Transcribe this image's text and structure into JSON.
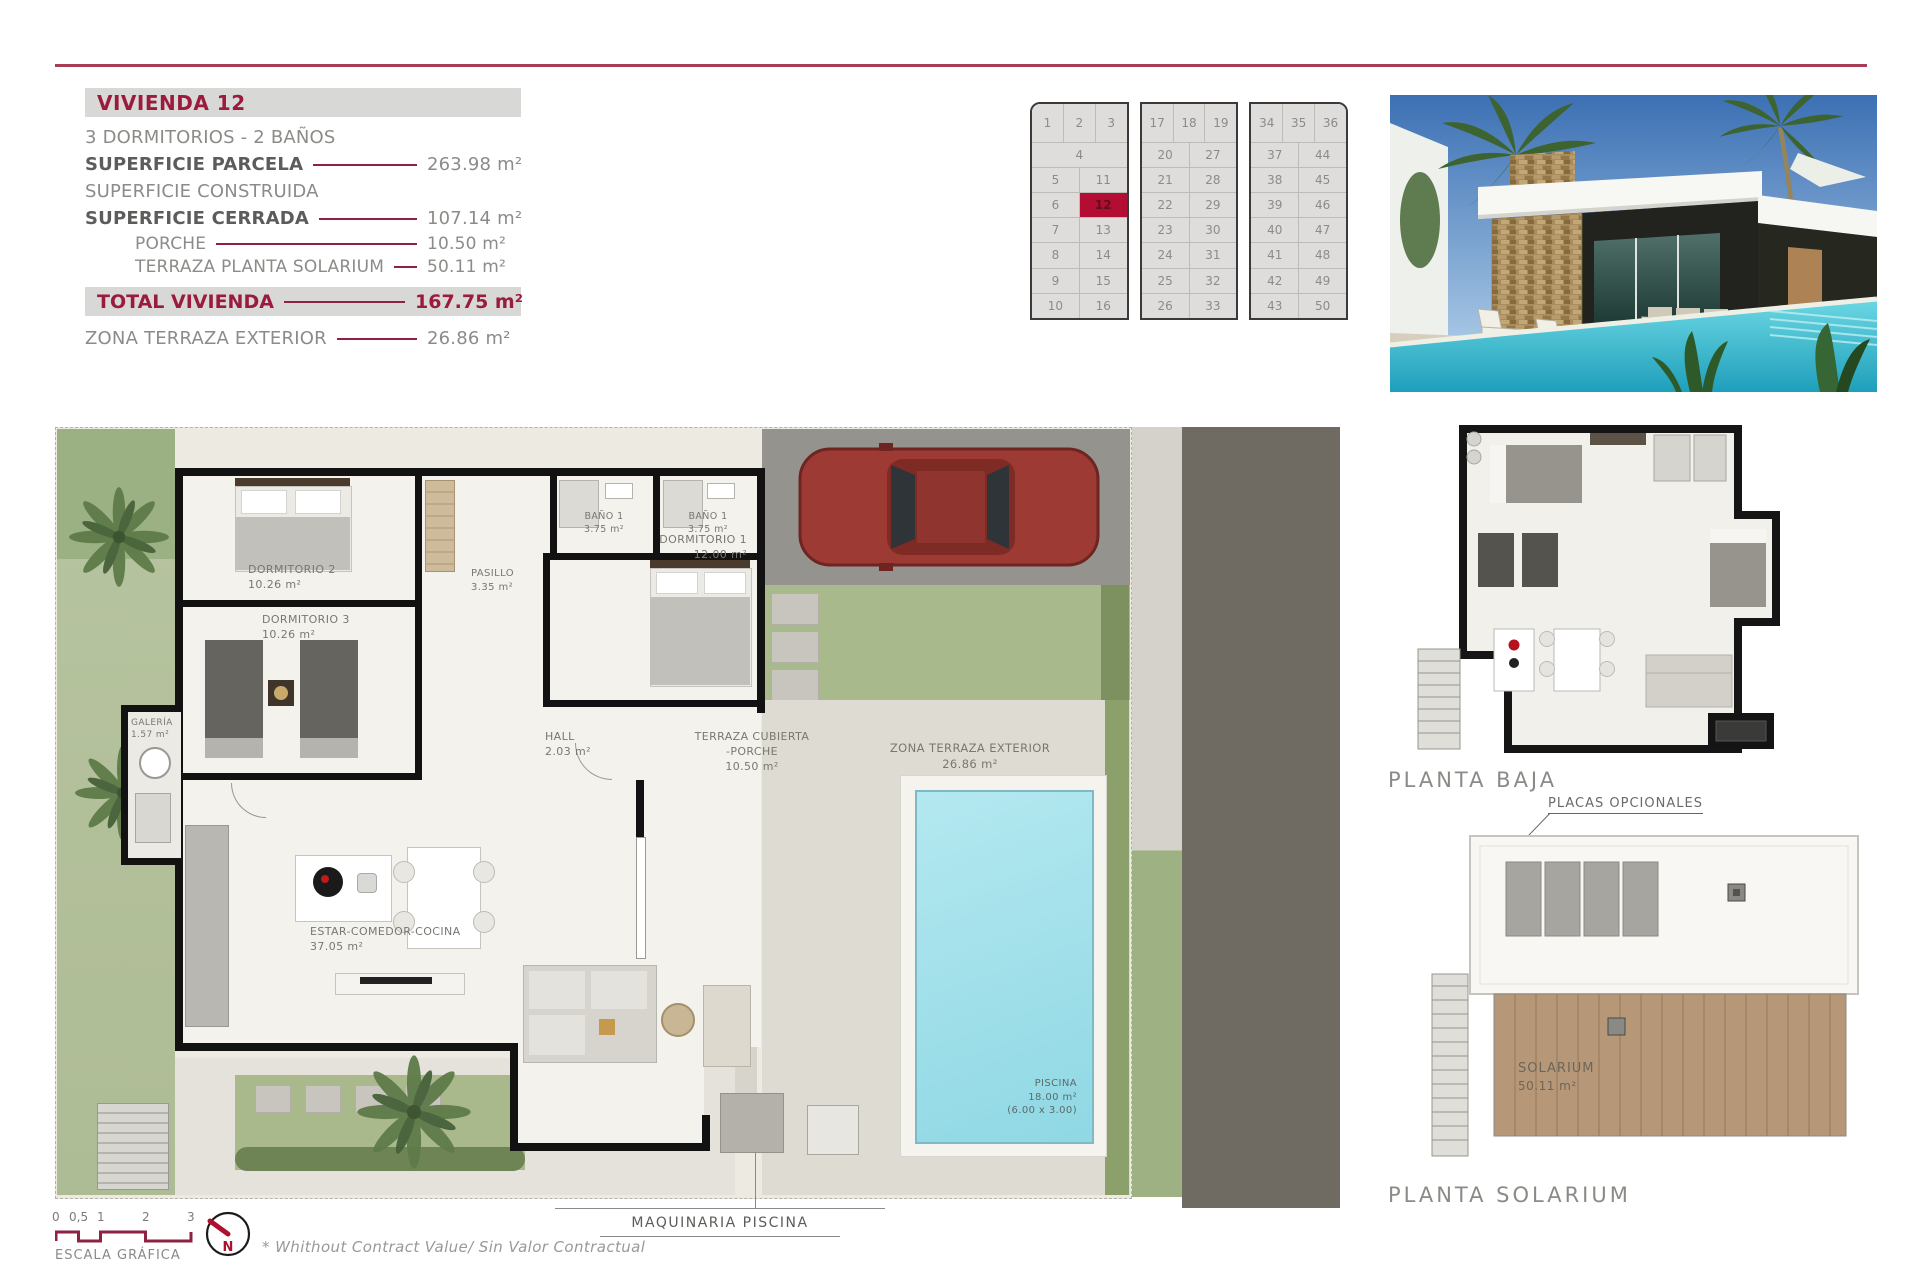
{
  "accent_colors": {
    "maroon": "#9b1b3c",
    "highlight_red": "#b30d33",
    "line_maroon": "#8e2240"
  },
  "info_panel": {
    "title": "VIVIENDA 12",
    "subtitle": "3 DORMITORIOS - 2 BAÑOS",
    "rows": [
      {
        "label": "SUPERFICIE PARCELA",
        "value": "263.98 m²"
      },
      {
        "label": "SUPERFICIE CONSTRUIDA",
        "value": ""
      },
      {
        "label": "SUPERFICIE CERRADA",
        "value": "107.14 m²"
      },
      {
        "label": "PORCHE",
        "value": "10.50 m²"
      },
      {
        "label": "TERRAZA PLANTA SOLARIUM",
        "value": "50.11 m²"
      }
    ],
    "total": {
      "label": "TOTAL VIVIENDA",
      "value": "167.75 m²"
    },
    "extra": {
      "label": "ZONA TERRAZA EXTERIOR",
      "value": "26.86 m²"
    }
  },
  "site_plan": {
    "highlighted": "12",
    "blocks": [
      {
        "top_row": [
          "1",
          "2",
          "3"
        ],
        "rows": [
          [
            "4"
          ],
          [
            "5",
            "11"
          ],
          [
            "6",
            "12"
          ],
          [
            "7",
            "13"
          ],
          [
            "8",
            "14"
          ],
          [
            "9",
            "15"
          ],
          [
            "10",
            "16"
          ]
        ]
      },
      {
        "top_row": [
          "17",
          "18",
          "19"
        ],
        "rows": [
          [
            "20",
            "27"
          ],
          [
            "21",
            "28"
          ],
          [
            "22",
            "29"
          ],
          [
            "23",
            "30"
          ],
          [
            "24",
            "31"
          ],
          [
            "25",
            "32"
          ],
          [
            "26",
            "33"
          ]
        ]
      },
      {
        "top_row": [
          "34",
          "35",
          "36"
        ],
        "rows": [
          [
            "37",
            "44"
          ],
          [
            "38",
            "45"
          ],
          [
            "39",
            "46"
          ],
          [
            "40",
            "47"
          ],
          [
            "41",
            "48"
          ],
          [
            "42",
            "49"
          ],
          [
            "43",
            "50"
          ]
        ]
      }
    ]
  },
  "floor_plan": {
    "rooms": [
      {
        "name": "DORMITORIO 2",
        "area": "10.26 m²"
      },
      {
        "name": "DORMITORIO 3",
        "area": "10.26 m²"
      },
      {
        "name": "BAÑO 1",
        "area": "3.75 m²"
      },
      {
        "name": "BAÑO 1",
        "area": "3.75 m²"
      },
      {
        "name": "PASILLO",
        "area": "3.35 m²"
      },
      {
        "name": "DORMITORIO 1",
        "area": "12.00 m²"
      },
      {
        "name": "GALERÍA",
        "area": "1.57 m²"
      },
      {
        "name": "HALL",
        "area": "2.03 m²"
      },
      {
        "name": "ESTAR-COMEDOR-COCINA",
        "area": "37.05 m²"
      },
      {
        "name": "TERRAZA CUBIERTA",
        "name2": "-PORCHE",
        "area": "10.50 m²"
      },
      {
        "name": "ZONA TERRAZA EXTERIOR",
        "area": "26.86 m²"
      },
      {
        "name": "PISCINA",
        "area": "18.00 m²",
        "note": "(6.00 x 3.00)"
      }
    ],
    "callout": "MAQUINARIA PISCINA"
  },
  "mini_plans": {
    "planta_baja_label": "PLANTA BAJA",
    "placas_label": "PLACAS OPCIONALES",
    "solarium_room": {
      "name": "SOLARIUM",
      "area": "50.11 m²"
    },
    "planta_solarium_label": "PLANTA SOLARIUM"
  },
  "footer": {
    "scale_ticks": [
      "0",
      "0,5",
      "1",
      "2",
      "3"
    ],
    "scale_label": "ESCALA GRÁFICA",
    "north_label": "N",
    "disclaimer": "* Whithout Contract Value/ Sin Valor Contractual"
  }
}
